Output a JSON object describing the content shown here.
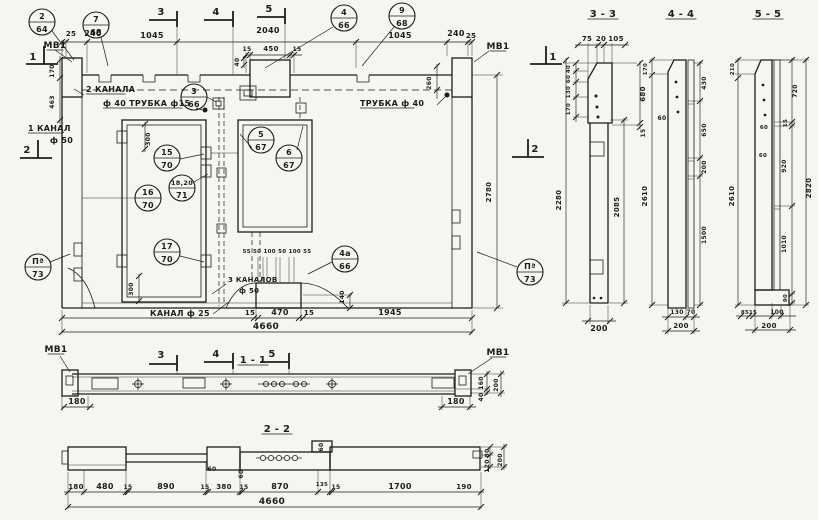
{
  "colors": {
    "ink": "#1c1c1c",
    "paper": "#f5f5f1"
  },
  "texts": [
    {
      "n": "label-mv1-top-left",
      "t": "МВ1",
      "x": 55,
      "y": 48,
      "s": 9,
      "u": 1
    },
    {
      "n": "dim-25-left",
      "t": "25",
      "x": 71,
      "y": 36,
      "s": 7
    },
    {
      "n": "dim-240-left",
      "t": "240",
      "x": 93,
      "y": 36,
      "s": 8
    },
    {
      "n": "dim-1045-left",
      "t": "1045",
      "x": 152,
      "y": 38,
      "s": 8
    },
    {
      "n": "dim-2040",
      "t": "2040",
      "x": 268,
      "y": 33,
      "s": 8
    },
    {
      "n": "dim-15-sub-l",
      "t": "15",
      "x": 247,
      "y": 51,
      "s": 6
    },
    {
      "n": "dim-450-sub",
      "t": "450",
      "x": 271,
      "y": 51,
      "s": 7
    },
    {
      "n": "dim-15-sub-r",
      "t": "15",
      "x": 297,
      "y": 51,
      "s": 6
    },
    {
      "n": "dim-40-rot",
      "t": "40",
      "x": 239,
      "y": 62,
      "s": 6,
      "r": 1
    },
    {
      "n": "dim-1045-right",
      "t": "1045",
      "x": 400,
      "y": 38,
      "s": 8
    },
    {
      "n": "dim-240-right",
      "t": "240",
      "x": 456,
      "y": 36,
      "s": 8
    },
    {
      "n": "dim-25-right",
      "t": "25",
      "x": 471,
      "y": 38,
      "s": 7
    },
    {
      "n": "label-mv1-top-right",
      "t": "МВ1",
      "x": 498,
      "y": 49,
      "s": 9,
      "u": 1
    },
    {
      "n": "dim-170-left",
      "t": "170",
      "x": 54,
      "y": 71,
      "s": 6,
      "r": 1
    },
    {
      "n": "dim-463-left",
      "t": "463",
      "x": 54,
      "y": 102,
      "s": 6,
      "r": 1
    },
    {
      "n": "label-2-kanala",
      "t": "2 КАНАЛА",
      "x": 86,
      "y": 92,
      "s": 8,
      "a": "start",
      "u": 1
    },
    {
      "n": "label-truba-40-15",
      "t": "ф 40  ТРУБКА ф15",
      "x": 103,
      "y": 106,
      "s": 8,
      "a": "start",
      "u": 1
    },
    {
      "n": "label-1-kanal",
      "t": "1 КАНАЛ",
      "x": 28,
      "y": 131,
      "s": 8,
      "a": "start",
      "u": 1
    },
    {
      "n": "label-f-50",
      "t": "ф 50",
      "x": 50,
      "y": 143,
      "s": 8,
      "a": "start"
    },
    {
      "n": "label-trubka-40",
      "t": "ТРУБКА ф 40",
      "x": 360,
      "y": 106,
      "s": 8,
      "a": "start",
      "u": 1
    },
    {
      "n": "dim-260",
      "t": "260",
      "x": 431,
      "y": 83,
      "s": 6,
      "r": 1
    },
    {
      "n": "dim-2780",
      "t": "2780",
      "x": 491,
      "y": 192,
      "s": 7,
      "r": 1
    },
    {
      "n": "dim-300-top",
      "t": "300",
      "x": 150,
      "y": 139,
      "s": 6,
      "r": 1
    },
    {
      "n": "dim-300-bottom",
      "t": "300",
      "x": 133,
      "y": 289,
      "s": 6,
      "r": 1
    },
    {
      "n": "label-3-kanalov",
      "t": "3 КАНАЛОВ",
      "x": 228,
      "y": 282,
      "s": 7,
      "a": "start"
    },
    {
      "n": "label-f-50-bottom",
      "t": "ф 50",
      "x": 239,
      "y": 293,
      "s": 7,
      "a": "start"
    },
    {
      "n": "label-kanal-25",
      "t": "КАНАЛ ф 25",
      "x": 150,
      "y": 316,
      "s": 8,
      "a": "start",
      "u": 1
    },
    {
      "n": "dim-canal-row",
      "t": "55 50 100 50 100 55",
      "x": 277,
      "y": 253,
      "s": 5.5
    },
    {
      "n": "dim-140",
      "t": "140",
      "x": 344,
      "y": 297,
      "s": 6,
      "r": 1
    },
    {
      "n": "dim-15-bot-l",
      "t": "15",
      "x": 250,
      "y": 315,
      "s": 7
    },
    {
      "n": "dim-470",
      "t": "470",
      "x": 280,
      "y": 315,
      "s": 8
    },
    {
      "n": "dim-15-bot-r",
      "t": "15",
      "x": 309,
      "y": 315,
      "s": 7
    },
    {
      "n": "dim-1945",
      "t": "1945",
      "x": 390,
      "y": 315,
      "s": 8
    },
    {
      "n": "dim-4660-main",
      "t": "4660",
      "x": 266,
      "y": 329,
      "s": 9
    },
    {
      "n": "title-section-1-1",
      "t": "1 - 1",
      "x": 253,
      "y": 363,
      "s": 10,
      "u": 1,
      "b": 1
    },
    {
      "n": "label-mv1-s1-left",
      "t": "МВ1",
      "x": 56,
      "y": 352,
      "s": 9,
      "u": 1
    },
    {
      "n": "dim-180-s1-left",
      "t": "180",
      "x": 77,
      "y": 404,
      "s": 8
    },
    {
      "n": "label-mv1-s1-right",
      "t": "МВ1",
      "x": 498,
      "y": 355,
      "s": 9,
      "u": 1
    },
    {
      "n": "dim-160-s1",
      "t": "160",
      "x": 483,
      "y": 383,
      "s": 6,
      "r": 1
    },
    {
      "n": "dim-40-s1",
      "t": "40",
      "x": 483,
      "y": 397,
      "s": 6,
      "r": 1
    },
    {
      "n": "dim-200-s1",
      "t": "200",
      "x": 498,
      "y": 385,
      "s": 6,
      "r": 1
    },
    {
      "n": "dim-180-s1-right",
      "t": "180",
      "x": 456,
      "y": 404,
      "s": 8
    },
    {
      "n": "title-section-2-2",
      "t": "2 - 2",
      "x": 277,
      "y": 432,
      "s": 10,
      "u": 1,
      "b": 1
    },
    {
      "n": "dim-180-s2",
      "t": "180",
      "x": 76,
      "y": 489,
      "s": 7
    },
    {
      "n": "dim-480-s2",
      "t": "480",
      "x": 105,
      "y": 489,
      "s": 8
    },
    {
      "n": "dim-15-s2a",
      "t": "15",
      "x": 128,
      "y": 489,
      "s": 6
    },
    {
      "n": "dim-890-s2",
      "t": "890",
      "x": 166,
      "y": 489,
      "s": 8
    },
    {
      "n": "dim-15-s2b",
      "t": "15",
      "x": 205,
      "y": 489,
      "s": 6
    },
    {
      "n": "dim-380-s2",
      "t": "380",
      "x": 224,
      "y": 489,
      "s": 7
    },
    {
      "n": "dim-15-s2c",
      "t": "15",
      "x": 244,
      "y": 489,
      "s": 6
    },
    {
      "n": "dim-870-s2",
      "t": "870",
      "x": 280,
      "y": 489,
      "s": 8
    },
    {
      "n": "dim-135-s2",
      "t": "135",
      "x": 322,
      "y": 486,
      "s": 5.5
    },
    {
      "n": "dim-15-s2d",
      "t": "15",
      "x": 336,
      "y": 489,
      "s": 6
    },
    {
      "n": "dim-1700-s2",
      "t": "1700",
      "x": 400,
      "y": 489,
      "s": 8
    },
    {
      "n": "dim-190-s2",
      "t": "190",
      "x": 464,
      "y": 489,
      "s": 7
    },
    {
      "n": "dim-4660-s2",
      "t": "4660",
      "x": 272,
      "y": 504,
      "s": 9
    },
    {
      "n": "dim-60-s2a",
      "t": "60",
      "x": 212,
      "y": 471,
      "s": 6
    },
    {
      "n": "dim-60-s2b",
      "t": "60",
      "x": 243,
      "y": 474,
      "s": 6,
      "r": 1
    },
    {
      "n": "dim-60-s2c",
      "t": "60",
      "x": 323,
      "y": 447,
      "s": 6,
      "r": 1
    },
    {
      "n": "dim-80-s2",
      "t": "80",
      "x": 489,
      "y": 453,
      "s": 6,
      "r": 1
    },
    {
      "n": "dim-120-s2",
      "t": "120",
      "x": 489,
      "y": 466,
      "s": 6,
      "r": 1
    },
    {
      "n": "dim-200-s2",
      "t": "200",
      "x": 502,
      "y": 460,
      "s": 6,
      "r": 1
    },
    {
      "n": "title-section-3-3",
      "t": "3 - 3",
      "x": 603,
      "y": 17,
      "s": 10,
      "u": 1,
      "b": 1
    },
    {
      "n": "dim-75-s3",
      "t": "75",
      "x": 587,
      "y": 41,
      "s": 7
    },
    {
      "n": "dim-20-s3",
      "t": "20",
      "x": 601,
      "y": 41,
      "s": 7
    },
    {
      "n": "dim-105-s3",
      "t": "105",
      "x": 616,
      "y": 41,
      "s": 7
    },
    {
      "n": "dim-40-s3",
      "t": "40",
      "x": 570,
      "y": 69,
      "s": 5.5,
      "r": 1
    },
    {
      "n": "dim-60-s3",
      "t": "60",
      "x": 570,
      "y": 79,
      "s": 5.5,
      "r": 1
    },
    {
      "n": "dim-130-s3",
      "t": "130",
      "x": 570,
      "y": 92,
      "s": 5.5,
      "r": 1
    },
    {
      "n": "dim-170-s3",
      "t": "170",
      "x": 570,
      "y": 109,
      "s": 5.5,
      "r": 1
    },
    {
      "n": "dim-680-s3",
      "t": "680",
      "x": 645,
      "y": 94,
      "s": 7,
      "r": 1
    },
    {
      "n": "dim-15-s3",
      "t": "15",
      "x": 645,
      "y": 133,
      "s": 6,
      "r": 1
    },
    {
      "n": "dim-2280-s3",
      "t": "2280",
      "x": 561,
      "y": 200,
      "s": 7,
      "r": 1
    },
    {
      "n": "dim-2085-s3",
      "t": "2085",
      "x": 619,
      "y": 207,
      "s": 7,
      "r": 1
    },
    {
      "n": "dim-200-s3",
      "t": "200",
      "x": 599,
      "y": 331,
      "s": 8
    },
    {
      "n": "title-section-4-4",
      "t": "4 - 4",
      "x": 681,
      "y": 17,
      "s": 10,
      "u": 1,
      "b": 1
    },
    {
      "n": "dim-170-s4",
      "t": "170",
      "x": 647,
      "y": 69,
      "s": 5.5,
      "r": 1
    },
    {
      "n": "dim-2610-s4",
      "t": "2610",
      "x": 647,
      "y": 196,
      "s": 7,
      "r": 1
    },
    {
      "n": "dim-60-s4",
      "t": "60",
      "x": 662,
      "y": 120,
      "s": 6
    },
    {
      "n": "dim-430-s4",
      "t": "430",
      "x": 706,
      "y": 83,
      "s": 6,
      "r": 1
    },
    {
      "n": "dim-650-s4",
      "t": "650",
      "x": 706,
      "y": 130,
      "s": 6,
      "r": 1
    },
    {
      "n": "dim-200-s4a",
      "t": "200",
      "x": 706,
      "y": 167,
      "s": 6,
      "r": 1
    },
    {
      "n": "dim-1500-s4",
      "t": "1500",
      "x": 706,
      "y": 235,
      "s": 6,
      "r": 1
    },
    {
      "n": "dim-130-s4",
      "t": "130",
      "x": 677,
      "y": 314,
      "s": 6
    },
    {
      "n": "dim-70-s4",
      "t": "70",
      "x": 691,
      "y": 314,
      "s": 6
    },
    {
      "n": "dim-200-s4b",
      "t": "200",
      "x": 681,
      "y": 328,
      "s": 7
    },
    {
      "n": "title-section-5-5",
      "t": "5 - 5",
      "x": 768,
      "y": 17,
      "s": 10,
      "u": 1,
      "b": 1
    },
    {
      "n": "dim-210-s5",
      "t": "210",
      "x": 734,
      "y": 69,
      "s": 5.5,
      "r": 1
    },
    {
      "n": "dim-2610-s5",
      "t": "2610",
      "x": 734,
      "y": 196,
      "s": 7,
      "r": 1
    },
    {
      "n": "dim-720-s5",
      "t": "720",
      "x": 797,
      "y": 91,
      "s": 6,
      "r": 1
    },
    {
      "n": "dim-15-s5",
      "t": "15",
      "x": 787,
      "y": 123,
      "s": 5.5,
      "r": 1
    },
    {
      "n": "dim-920-s5",
      "t": "920",
      "x": 786,
      "y": 166,
      "s": 6,
      "r": 1
    },
    {
      "n": "dim-1010-s5",
      "t": "1010",
      "x": 786,
      "y": 244,
      "s": 6,
      "r": 1
    },
    {
      "n": "dim-90-s5",
      "t": "90",
      "x": 787,
      "y": 298,
      "s": 5.5,
      "r": 1
    },
    {
      "n": "dim-60-s5a",
      "t": "60",
      "x": 764,
      "y": 129,
      "s": 5.5
    },
    {
      "n": "dim-60-s5b",
      "t": "60",
      "x": 763,
      "y": 157,
      "s": 5.5
    },
    {
      "n": "dim-2820-s5",
      "t": "2820",
      "x": 811,
      "y": 188,
      "s": 7,
      "r": 1
    },
    {
      "n": "dim-85-s5",
      "t": "85",
      "x": 745,
      "y": 314,
      "s": 5.5
    },
    {
      "n": "dim-15-s5b",
      "t": "15",
      "x": 753,
      "y": 314,
      "s": 5.5
    },
    {
      "n": "dim-100-s5",
      "t": "100",
      "x": 777,
      "y": 314,
      "s": 6
    },
    {
      "n": "dim-200-s5",
      "t": "200",
      "x": 769,
      "y": 328,
      "s": 7
    }
  ],
  "callouts": [
    {
      "top": "2",
      "bot": "64",
      "x": 42,
      "y": 22
    },
    {
      "top": "7",
      "bot": "68",
      "x": 96,
      "y": 25
    },
    {
      "top": "4",
      "bot": "66",
      "x": 344,
      "y": 18
    },
    {
      "top": "9",
      "bot": "68",
      "x": 402,
      "y": 16
    },
    {
      "top": "3",
      "bot": "66",
      "x": 194,
      "y": 97
    },
    {
      "top": "5",
      "bot": "67",
      "x": 261,
      "y": 140
    },
    {
      "top": "6",
      "bot": "67",
      "x": 289,
      "y": 158
    },
    {
      "top": "15",
      "bot": "70",
      "x": 167,
      "y": 158
    },
    {
      "top": "18,20",
      "bot": "71",
      "x": 182,
      "y": 188
    },
    {
      "top": "16",
      "bot": "70",
      "x": 148,
      "y": 198
    },
    {
      "top": "17",
      "bot": "70",
      "x": 167,
      "y": 252
    },
    {
      "top": "4а",
      "bot": "66",
      "x": 345,
      "y": 259
    },
    {
      "top": "Пª",
      "bot": "73",
      "x": 38,
      "y": 267
    },
    {
      "top": "Пª",
      "bot": "73",
      "x": 530,
      "y": 272
    }
  ],
  "marks": [
    {
      "t": "3",
      "x": 161,
      "y": 15,
      "bar": [
        149,
        20,
        177,
        20
      ],
      "tick": [
        177,
        11,
        177,
        27
      ],
      "ext": [
        177,
        27,
        177,
        74
      ]
    },
    {
      "t": "4",
      "x": 216,
      "y": 15,
      "bar": [
        204,
        20,
        233,
        20
      ],
      "tick": [
        233,
        11,
        233,
        27
      ],
      "ext": [
        233,
        27,
        233,
        74
      ]
    },
    {
      "t": "5",
      "x": 269,
      "y": 12,
      "bar": [
        257,
        17,
        285,
        17
      ],
      "tick": [
        285,
        8,
        285,
        24
      ],
      "ext": [
        285,
        24,
        285,
        59
      ]
    },
    {
      "t": "3",
      "x": 161,
      "y": 358,
      "bar": [
        149,
        364,
        177,
        364
      ],
      "tick": [
        177,
        355,
        177,
        371
      ],
      "ext": [
        177,
        364,
        177,
        374
      ]
    },
    {
      "t": "4",
      "x": 216,
      "y": 357,
      "bar": [
        204,
        362,
        233,
        362
      ],
      "tick": [
        233,
        353,
        233,
        369
      ],
      "ext": [
        233,
        362,
        233,
        374
      ]
    },
    {
      "t": "5",
      "x": 272,
      "y": 357,
      "bar": [
        260,
        362,
        289,
        362
      ],
      "tick": [
        289,
        353,
        289,
        369
      ],
      "ext": [
        289,
        362,
        289,
        374
      ]
    },
    {
      "t": "1",
      "x": 33,
      "y": 60,
      "bar": [
        26,
        64,
        58,
        64
      ],
      "tick": [
        44,
        46,
        44,
        64
      ]
    },
    {
      "t": "2",
      "x": 27,
      "y": 153,
      "bar": [
        20,
        158,
        52,
        158
      ],
      "tick": [
        38,
        140,
        38,
        158
      ]
    },
    {
      "t": "1",
      "x": 553,
      "y": 60,
      "bar": [
        530,
        64,
        562,
        64
      ],
      "tick": [
        546,
        46,
        546,
        64
      ]
    },
    {
      "t": "2",
      "x": 535,
      "y": 152,
      "bar": [
        512,
        157,
        544,
        157
      ],
      "tick": [
        528,
        139,
        528,
        157
      ]
    }
  ]
}
